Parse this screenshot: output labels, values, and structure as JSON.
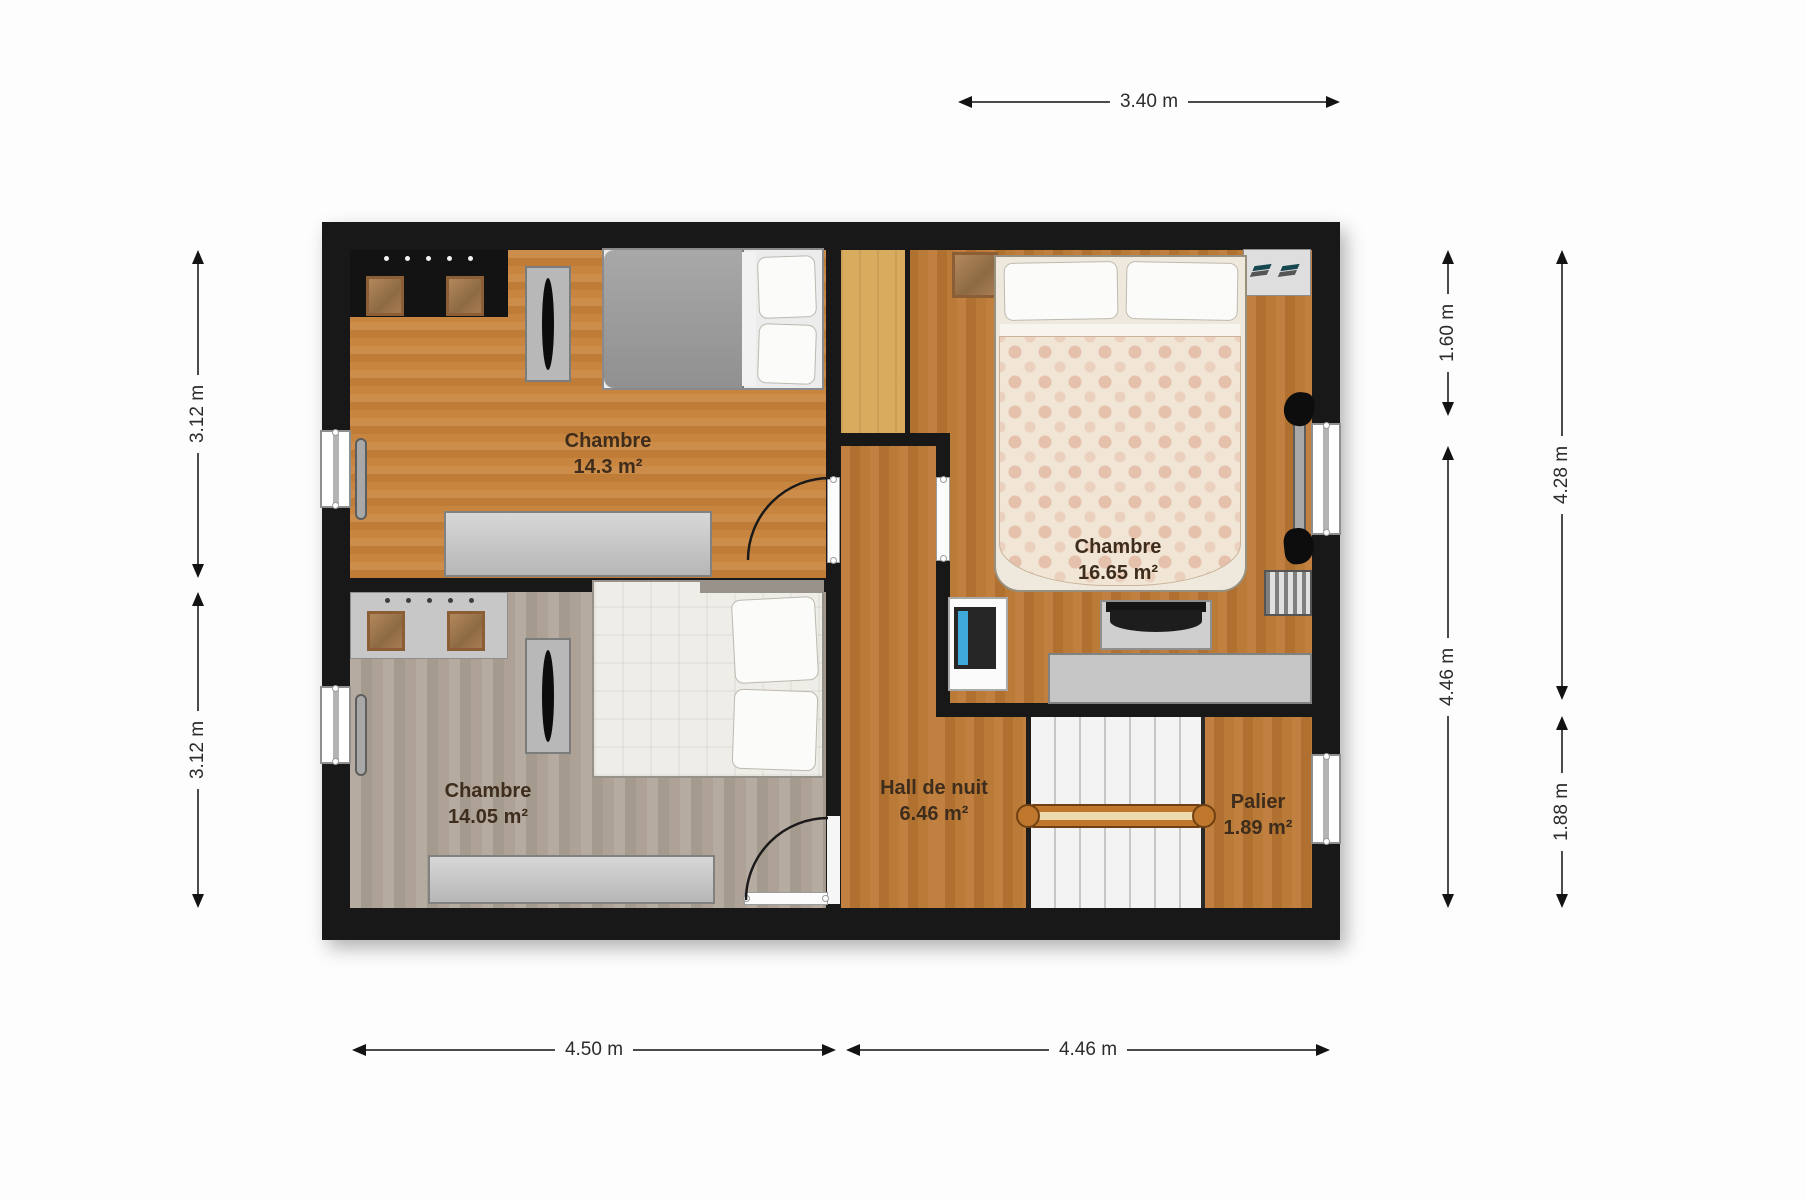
{
  "title": "Floor plan — upper level",
  "rooms": [
    {
      "id": "chambre-1",
      "name": "Chambre",
      "area": "14.3 m²"
    },
    {
      "id": "chambre-2",
      "name": "Chambre",
      "area": "16.65 m²"
    },
    {
      "id": "chambre-3",
      "name": "Chambre",
      "area": "14.05 m²"
    },
    {
      "id": "hall",
      "name": "Hall de nuit",
      "area": "6.46 m²"
    },
    {
      "id": "palier",
      "name": "Palier",
      "area": "1.89 m²"
    }
  ],
  "dimensions": {
    "top": "3.40 m",
    "bottom": [
      "4.50 m",
      "4.46 m"
    ],
    "left": [
      "3.12 m",
      "3.12 m"
    ],
    "right_inner": [
      "1.60 m",
      "4.46 m"
    ],
    "right_outer": [
      "4.28 m",
      "1.88 m"
    ]
  },
  "colors": {
    "wall": "#181818",
    "wood_orange": "#c5853f",
    "wood_gray": "#b0a499",
    "wood_tan": "#d8ab5f",
    "stair_rail": "#bf772e",
    "dimension_line": "#4b4b4b",
    "label_text": "#3e2d1c",
    "background": "#fdfdfd"
  }
}
